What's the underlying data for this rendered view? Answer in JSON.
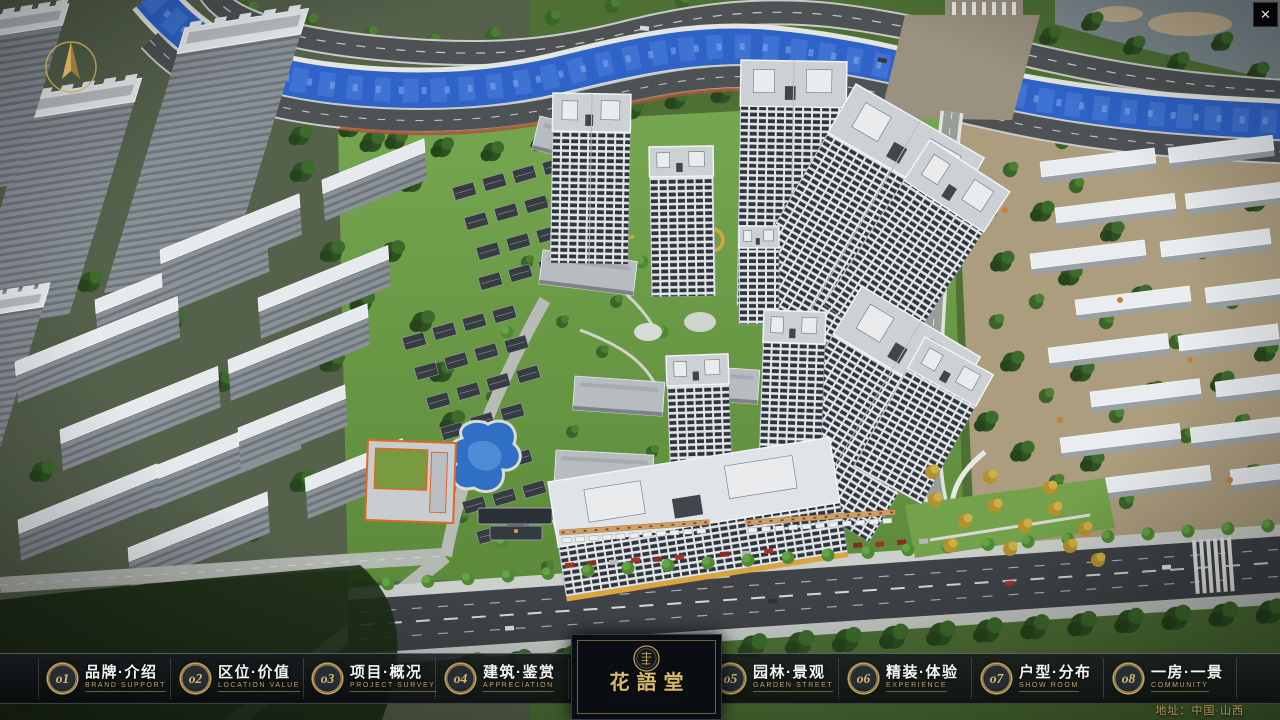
{
  "ui": {
    "close_glyph": "✕",
    "address": "地址：中国·山西",
    "logo": {
      "title": "花語堂",
      "subtitle": "· · · · · · · ·"
    },
    "nav": {
      "items": [
        {
          "num": "o1",
          "zh": "品牌·介绍",
          "en": "BRAND SUPPORT"
        },
        {
          "num": "o2",
          "zh": "区位·价值",
          "en": "LOCATION VALUE"
        },
        {
          "num": "o3",
          "zh": "项目·概况",
          "en": "PROJECT SURVEY"
        },
        {
          "num": "o4",
          "zh": "建筑·鉴赏",
          "en": "APPRECIATION"
        },
        {
          "num": "o5",
          "zh": "园林·景观",
          "en": "GARDEN STREET"
        },
        {
          "num": "o6",
          "zh": "精装·体验",
          "en": "EXPERIENCE"
        },
        {
          "num": "o7",
          "zh": "户型·分布",
          "en": "SHOW ROOM"
        },
        {
          "num": "o8",
          "zh": "一房·一景",
          "en": "COMMUNITY"
        }
      ]
    },
    "scene_palette": {
      "accent_gold": "#c9a85c",
      "river_blue": "#2f63c8",
      "grass_green": "#6fa04a",
      "asphalt": "#44484c",
      "roof_white": "#e7ebee"
    }
  }
}
